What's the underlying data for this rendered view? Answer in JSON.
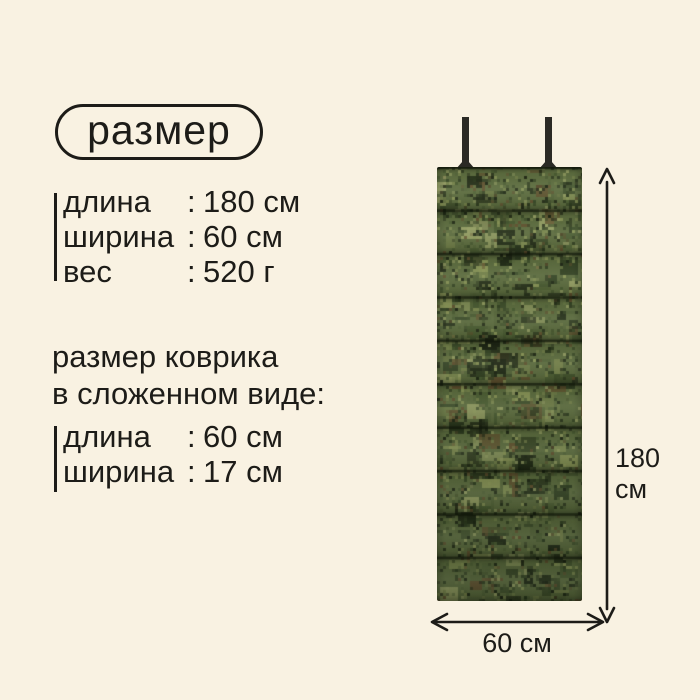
{
  "ui": {
    "colon": ":"
  },
  "badge": {
    "label": "размер"
  },
  "specs_main": {
    "rows": [
      {
        "label": "длина",
        "value": "180 см"
      },
      {
        "label": "ширина",
        "value": "60 см"
      },
      {
        "label": "вес",
        "value": "520 г"
      }
    ]
  },
  "folded": {
    "title_line1": "размер коврика",
    "title_line2": "в сложенном виде:",
    "rows": [
      {
        "label": "длина",
        "value": "60 см"
      },
      {
        "label": "ширина",
        "value": "17 см"
      }
    ]
  },
  "diagram": {
    "height_value": "180",
    "height_unit": "см",
    "width_label": "60 см",
    "mat_panels": 10
  },
  "icons": {
    "height_arrow": "double-headed-vertical-arrow",
    "width_arrow": "double-headed-horizontal-arrow"
  },
  "colors": {
    "background": "#f9f2e2",
    "text": "#1d1c18",
    "strap": "#2b2a24",
    "camo_base": "#5e6e40",
    "camo_palette": [
      "#78854c",
      "#8e9a5a",
      "#98a266",
      "#55663a",
      "#4a5c32",
      "#3a4a28",
      "#2c3a1e",
      "#1f2815",
      "#1f2815",
      "#63512f"
    ],
    "seam": "rgba(16,22,10,0.62)"
  }
}
